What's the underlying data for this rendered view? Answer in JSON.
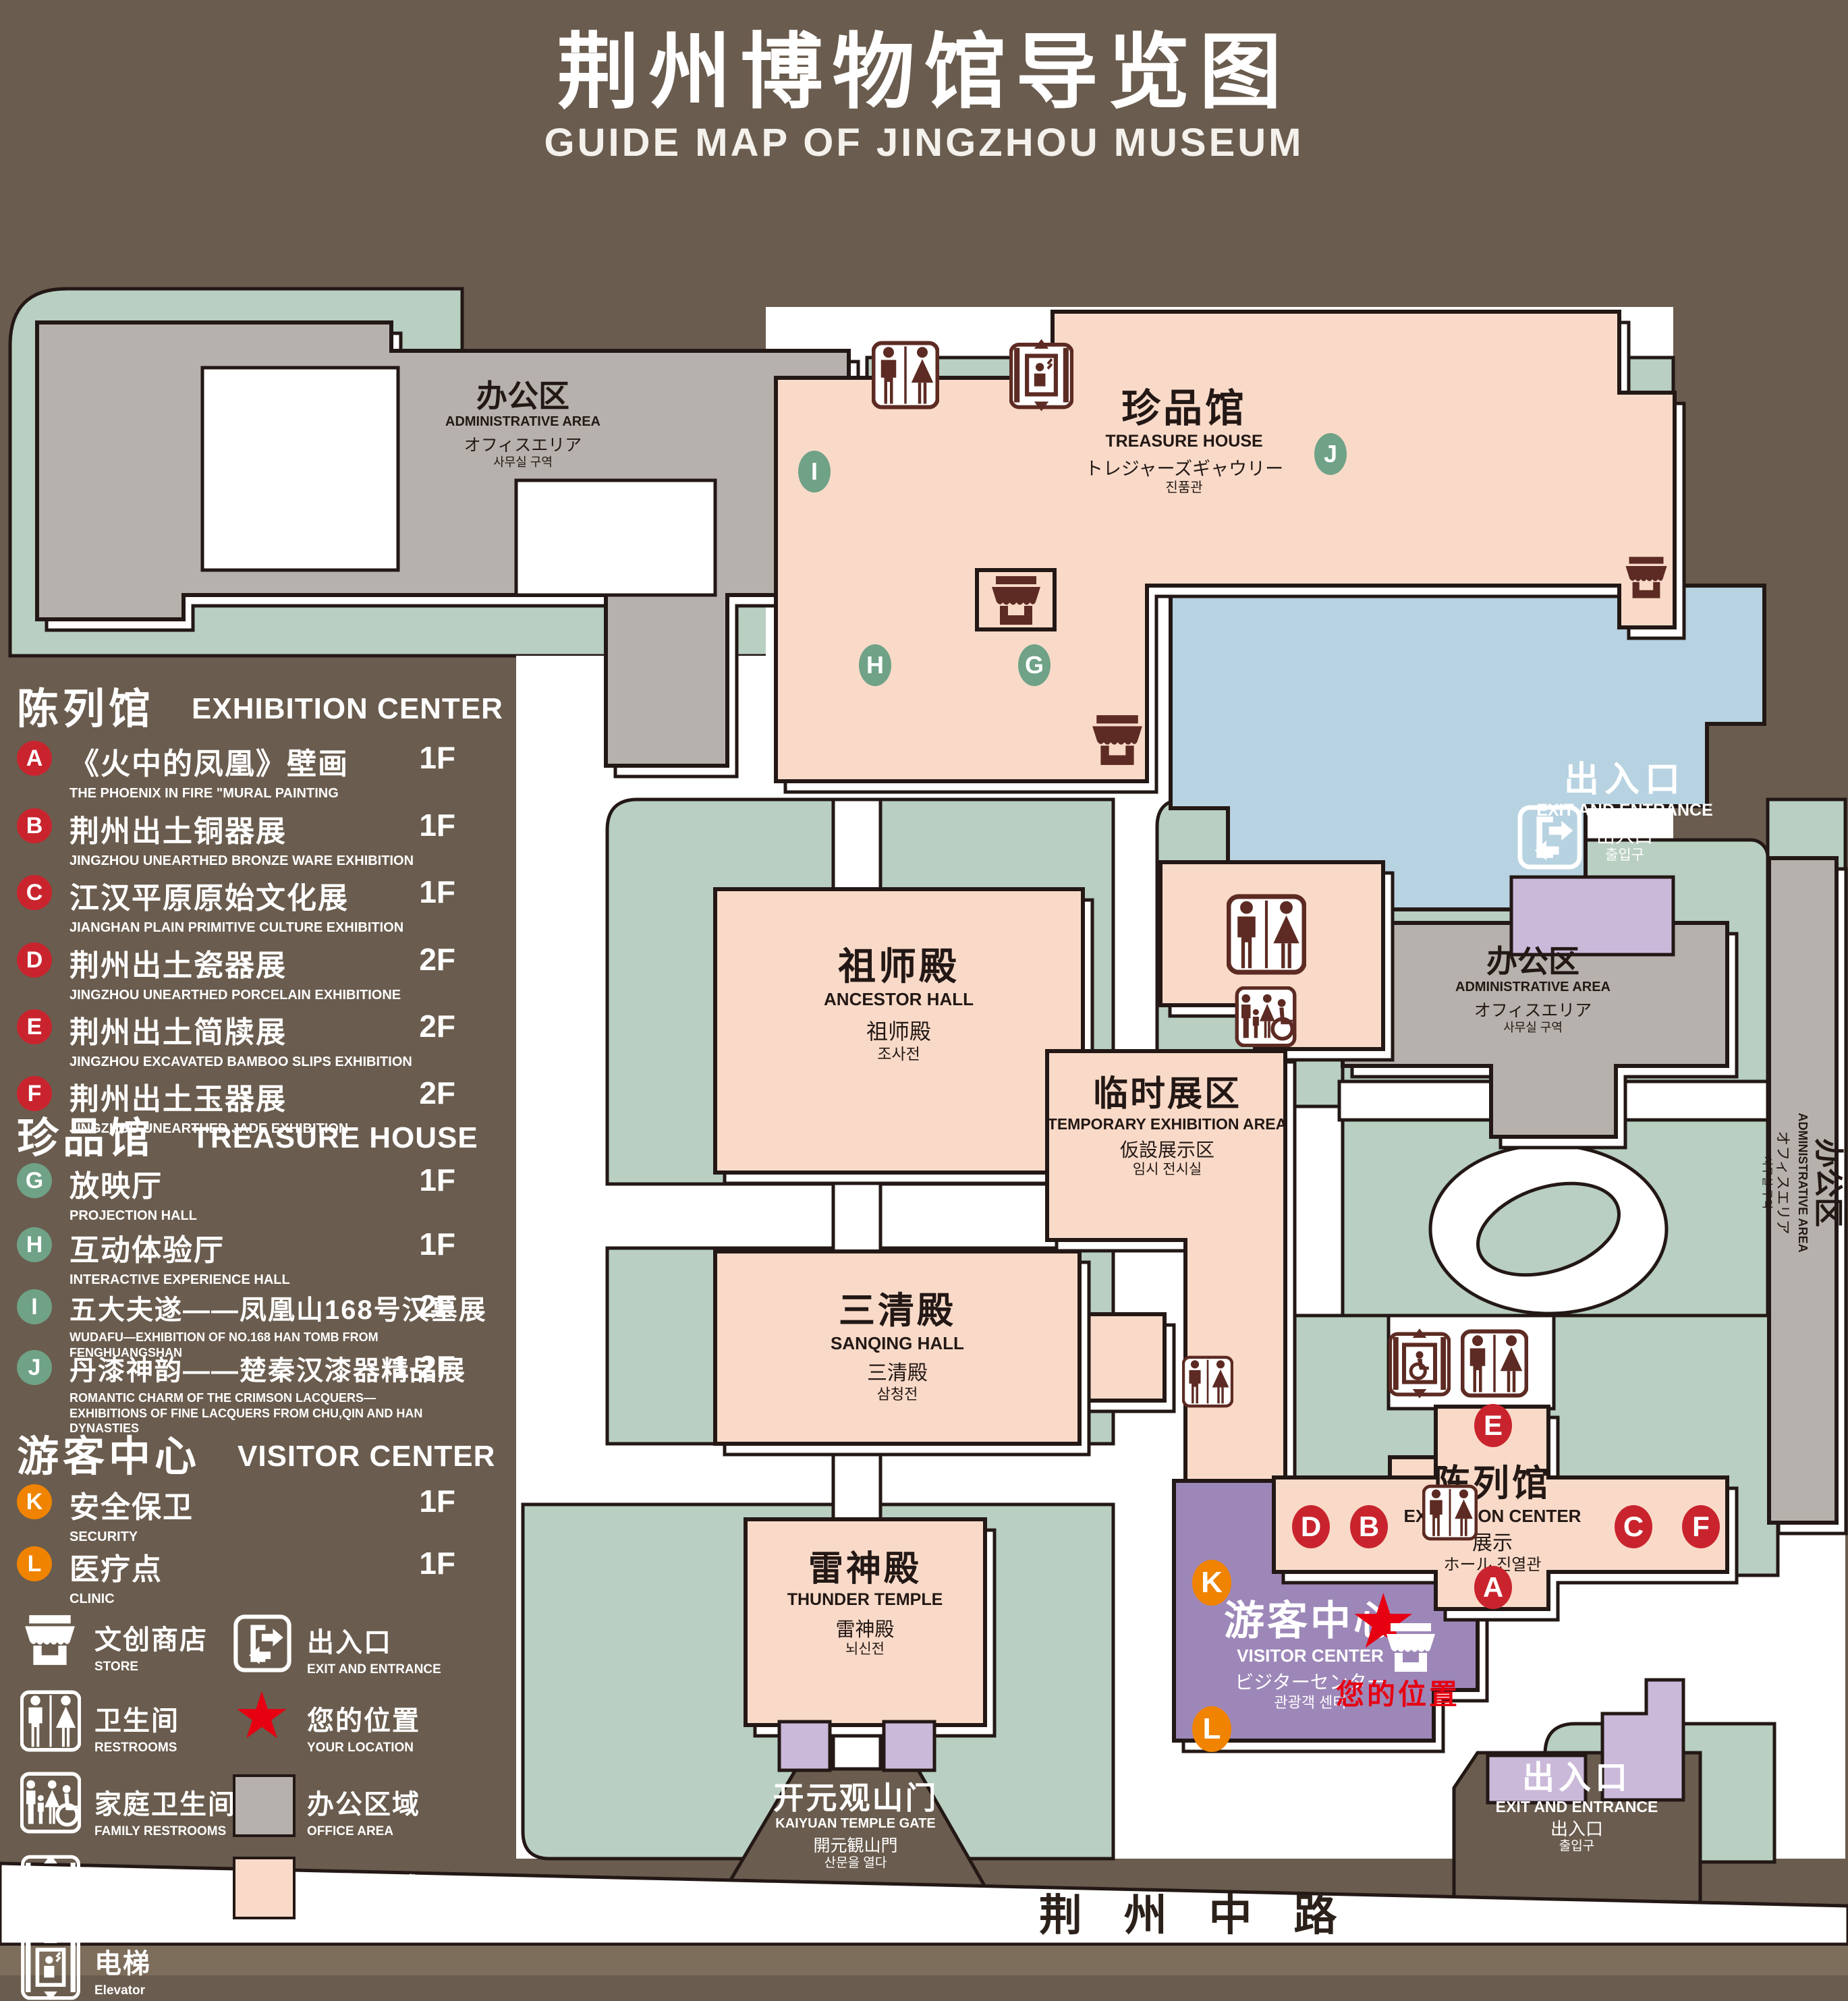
{
  "header": {
    "title_zh": "荆州博物馆导览图",
    "title_en": "GUIDE MAP OF JINGZHOU MUSEUM"
  },
  "legend": {
    "sections": [
      {
        "heading_zh": "陈列馆",
        "heading_en": "EXHIBITION CENTER",
        "items": [
          {
            "id": "A",
            "zh": "《火中的凤凰》壁画",
            "en": "THE PHOENIX IN FIRE \"MURAL PAINTING",
            "floor": "1F"
          },
          {
            "id": "B",
            "zh": "荆州出土铜器展",
            "en": "JINGZHOU UNEARTHED BRONZE WARE EXHIBITION",
            "floor": "1F"
          },
          {
            "id": "C",
            "zh": "江汉平原原始文化展",
            "en": "JIANGHAN PLAIN PRIMITIVE CULTURE EXHIBITION",
            "floor": "1F"
          },
          {
            "id": "D",
            "zh": "荆州出土瓷器展",
            "en": "JINGZHOU UNEARTHED PORCELAIN EXHIBITIONE",
            "floor": "2F"
          },
          {
            "id": "E",
            "zh": "荆州出土简牍展",
            "en": "JINGZHOU EXCAVATED BAMBOO SLIPS EXHIBITION",
            "floor": "2F"
          },
          {
            "id": "F",
            "zh": "荆州出土玉器展",
            "en": "JINGZHOU UNEARTHED JADE EXHIBITION",
            "floor": "2F"
          }
        ]
      },
      {
        "heading_zh": "珍品馆",
        "heading_en": "TREASURE HOUSE",
        "items": [
          {
            "id": "G",
            "zh": "放映厅",
            "en": "PROJECTION HALL",
            "floor": "1F"
          },
          {
            "id": "H",
            "zh": "互动体验厅",
            "en": "INTERACTIVE EXPERIENCE HALL",
            "floor": "1F"
          },
          {
            "id": "I",
            "zh": "五大夫遂——凤凰山168号汉墓展",
            "en": "WUDAFU—EXHIBITION OF NO.168 HAN TOMB FROM FENGHUANGSHAN",
            "floor": "2F"
          },
          {
            "id": "J",
            "zh": "丹漆神韵——楚秦汉漆器精品展",
            "en": "ROMANTIC CHARM OF THE CRIMSON LACQUERS—EXHIBITIONS OF FINE LACQUERS FROM CHU,QIN AND HAN DYNASTIES",
            "floor": "1-2F"
          }
        ]
      },
      {
        "heading_zh": "游客中心",
        "heading_en": "VISITOR CENTER",
        "items": [
          {
            "id": "K",
            "zh": "安全保卫",
            "en": "SECURITY",
            "floor": "1F"
          },
          {
            "id": "L",
            "zh": "医疗点",
            "en": "CLINIC",
            "floor": "1F"
          }
        ]
      }
    ],
    "icon_items": [
      {
        "icon": "store-icon",
        "zh": "文创商店",
        "en": "STORE"
      },
      {
        "icon": "restroom-icon",
        "zh": "卫生间",
        "en": "RESTROOMS"
      },
      {
        "icon": "family-restroom-icon",
        "zh": "家庭卫生间",
        "en": "FAMILY RESTROOMS"
      },
      {
        "icon": "accessible-elevator-icon",
        "zh": "无障碍电梯",
        "en": "ACCESSIBLE ELEVATOR"
      },
      {
        "icon": "elevator-icon",
        "zh": "电梯",
        "en": "Elevator"
      },
      {
        "icon": "exit-icon",
        "zh": "出入口",
        "en": "EXIT AND ENTRANCE"
      },
      {
        "icon": "location-star",
        "zh": "您的位置",
        "en": "YOUR LOCATION"
      },
      {
        "icon": "office-swatch",
        "zh": "办公区域",
        "en": "OFFICE AREA"
      },
      {
        "icon": "display-swatch",
        "zh": "展示区域",
        "en": "DISPLAY AREA"
      }
    ]
  },
  "map": {
    "admin": {
      "zh": "办公区",
      "en": "ADMINISTRATIVE AREA",
      "jp": "オフィスエリア",
      "kr": "사무실 구역"
    },
    "treasure": {
      "zh": "珍品馆",
      "en": "TREASURE HOUSE",
      "jp": "トレジャーズギャウリー",
      "kr": "진품관"
    },
    "exit": {
      "zh": "出入口",
      "en": "EXIT AND ENTRANCE",
      "jp": "出入口",
      "kr": "출입구"
    },
    "ancestor": {
      "zh": "祖师殿",
      "en": "ANCESTOR HALL",
      "jp": "祖师殿",
      "kr": "조사전"
    },
    "temp": {
      "zh": "临时展区",
      "en": "TEMPORARY EXHIBITION AREA",
      "jp": "仮設展示区",
      "kr": "임시 전시실"
    },
    "sanqing": {
      "zh": "三清殿",
      "en": "SANQING HALL",
      "jp": "三清殿",
      "kr": "삼청전"
    },
    "thunder": {
      "zh": "雷神殿",
      "en": "THUNDER TEMPLE",
      "jp": "雷神殿",
      "kr": "뇌신전"
    },
    "visitor": {
      "zh": "游客中心",
      "en": "VISITOR CENTER",
      "jp": "ビジターセンター",
      "kr": "관광객 센터"
    },
    "exhibition": {
      "zh": "陈列馆",
      "en": "EXHIBITION CENTER",
      "jp1": "展示",
      "jp2": "ホール",
      "kr": "진열관"
    },
    "gate": {
      "zh": "开元观山门",
      "en": "KAIYUAN TEMPLE GATE",
      "jp": "開元観山門",
      "kr": "산문을 열다"
    },
    "road": "荆 州 中 路",
    "your_location": "您的位置",
    "star_glyph": "★",
    "marker_ids": [
      "A",
      "B",
      "C",
      "D",
      "E",
      "F",
      "G",
      "H",
      "I",
      "J",
      "K",
      "L"
    ]
  },
  "colors": {
    "background": "#6a5c4e",
    "lawn_green": "#b8cfc2",
    "display_pink": "#f9dac8",
    "office_gray": "#b6b1ac",
    "pond_blue": "#b7d2e1",
    "visitor_purple": "#9d87b8",
    "gate_purple": "#cbb9da",
    "marker_red": "#c9242e",
    "marker_green": "#6fa287",
    "marker_orange": "#f08300",
    "icon_maroon": "#5d2b23",
    "location_red": "#e60012",
    "outline": "#231815"
  }
}
